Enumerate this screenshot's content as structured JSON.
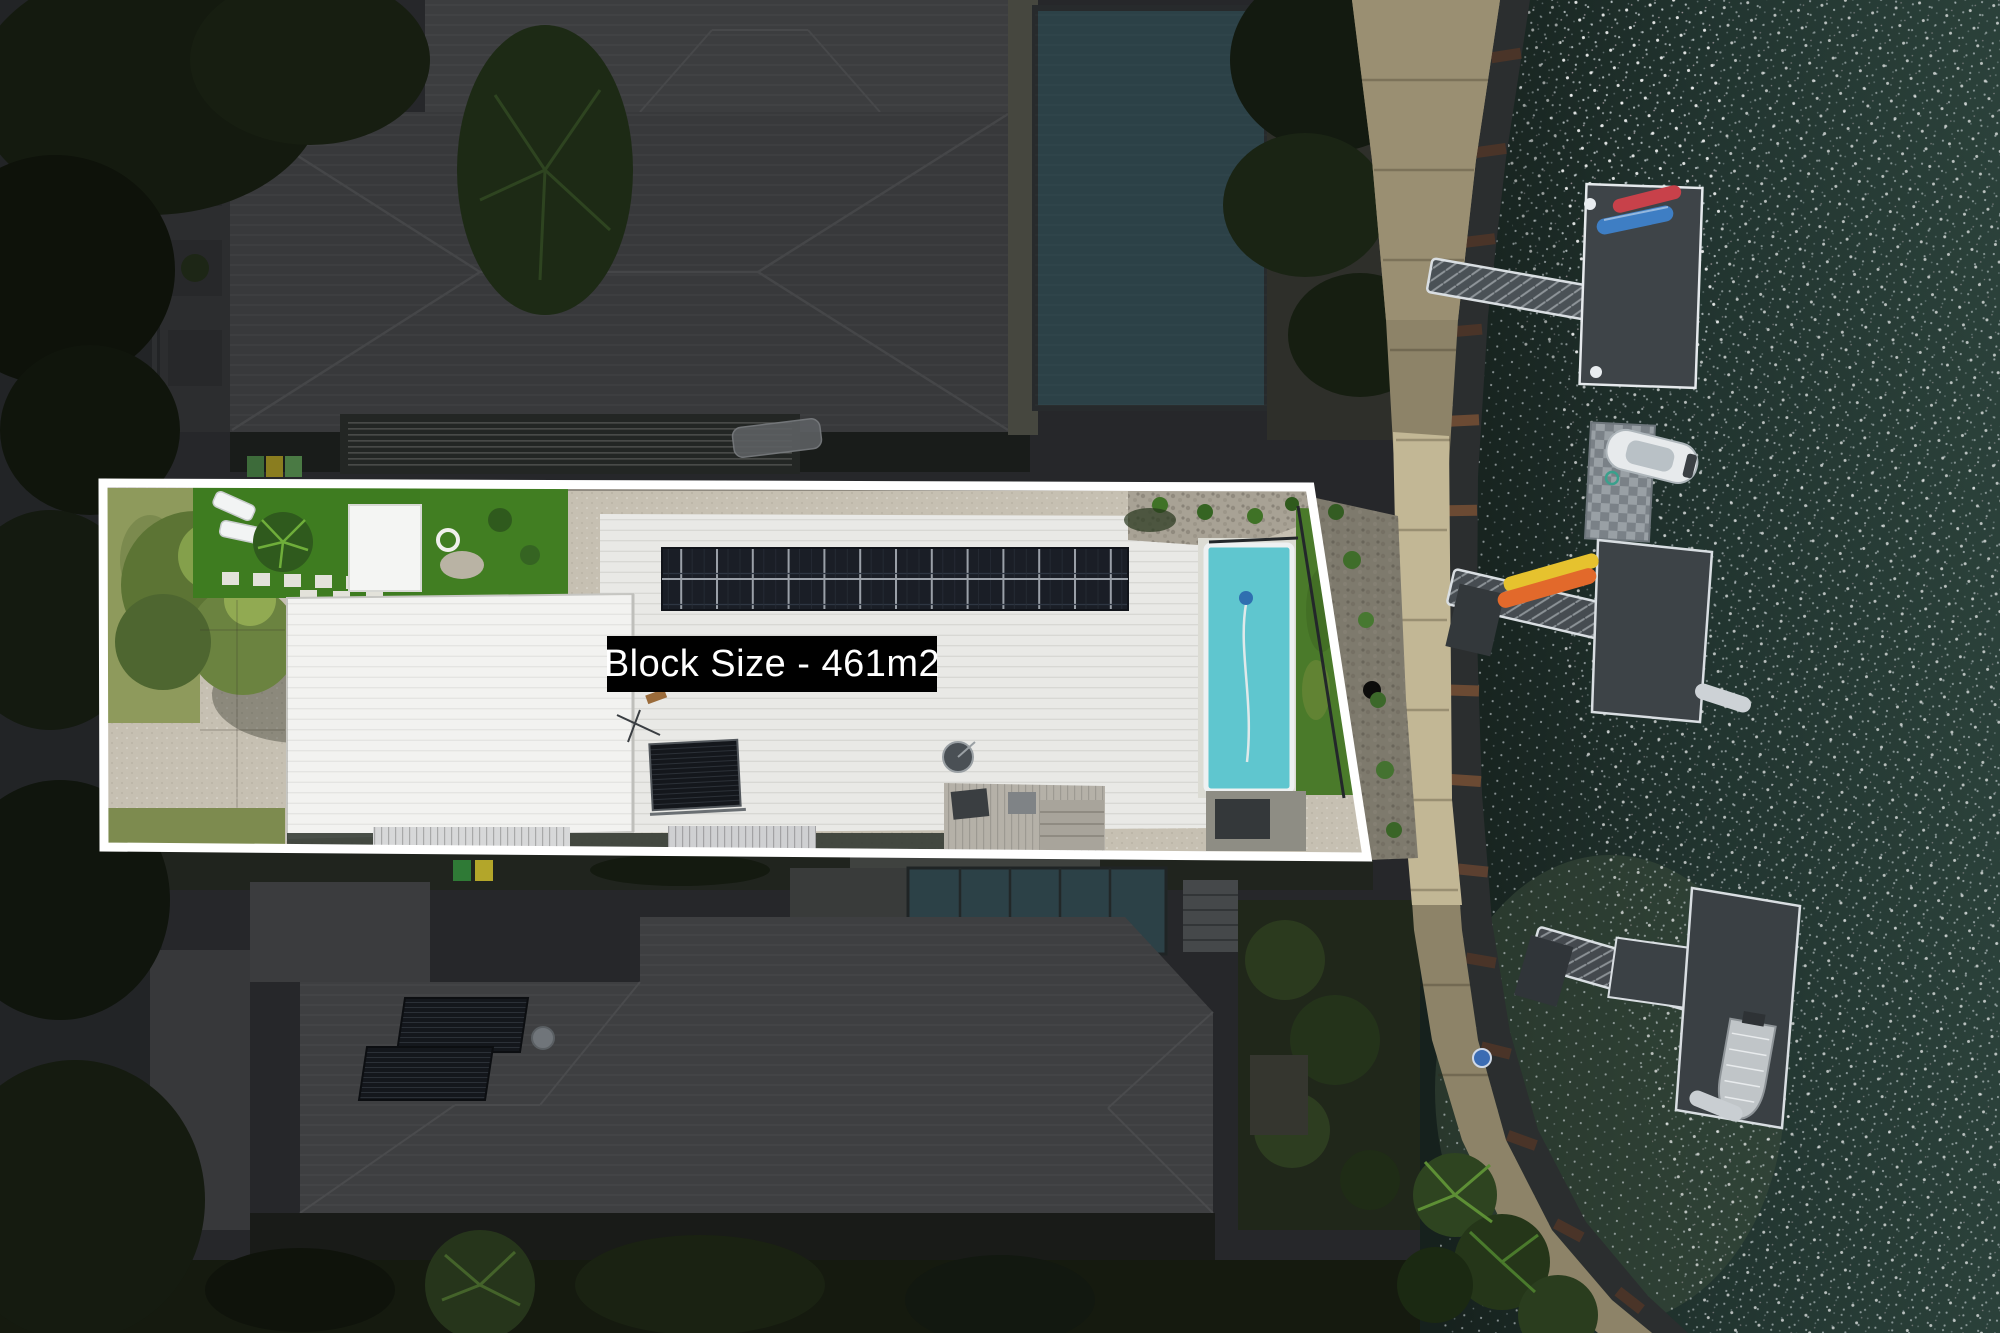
{
  "overlay": {
    "block_size_label": "Block Size - 461m2"
  },
  "colors": {
    "boundary": "#ffffff",
    "label_background": "#000000",
    "label_text": "#ffffff",
    "property_pool": "#5fc6cf",
    "neighbor_pool": "#2c4147",
    "water_base": "#223530",
    "walkway": "#a2957a",
    "kayak_red": "#c8414a",
    "kayak_blue": "#3e7ec4",
    "kayak_orange": "#e2692b",
    "kayak_yellow": "#e6c22e",
    "boat_hull": "#e7eaec",
    "dinghy": "#c0c5c8",
    "walkway_sign": "#3b6cb3"
  }
}
